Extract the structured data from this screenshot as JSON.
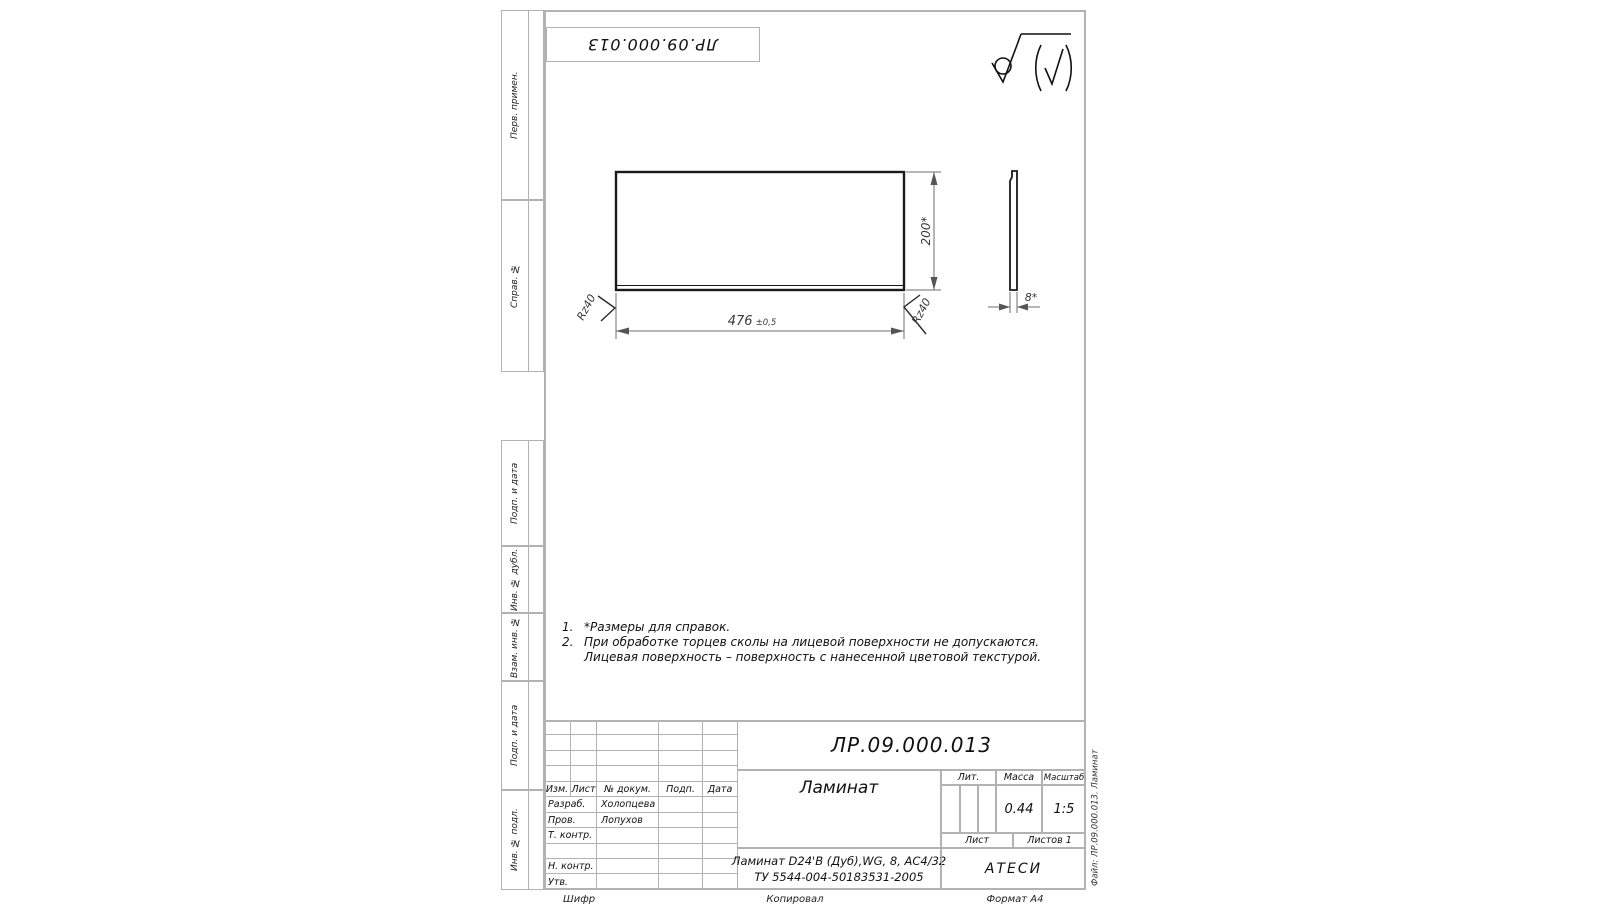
{
  "palette": {
    "frame_line": "#b2b2b2",
    "ink": "#1a1a1a"
  },
  "frame": {
    "stamp_designation": "ЛР.09.000.013",
    "file_note": "Файл: ЛР.09.000.013. Ламинат",
    "left_labels": [
      "Перв. примен.",
      "Справ. №",
      "Подп. и дата",
      "Инв. № дубл.",
      "Взам. инв. №",
      "Подп. и дата",
      "Инв. № подл."
    ],
    "footer": {
      "cipher": "Шифр",
      "copied": "Копировал",
      "format": "Формат А4"
    }
  },
  "drawing": {
    "dim_width_value": "476",
    "dim_width_tol": "±0,5",
    "dim_height": "200*",
    "dim_thickness": "8*",
    "roughness_left": "Rz40",
    "roughness_right": "Rz40"
  },
  "notes": {
    "items": [
      {
        "num": "1.",
        "line1": "*Размеры для справок.",
        "line2": ""
      },
      {
        "num": "2.",
        "line1": "При обработке торцев сколы на лицевой поверхности не допускаются.",
        "line2": "Лицевая поверхность – поверхность с нанесенной цветовой текстурой."
      }
    ]
  },
  "title_block": {
    "designation": "ЛР.09.000.013",
    "part_name": "Ламинат",
    "material_line1": "Ламинат D24'В (Дуб),WG, 8, АС4/32",
    "material_line2": "ТУ 5544-004-50183531-2005",
    "cols": {
      "izm": "Изм.",
      "list": "Лист",
      "doc": "№ докум.",
      "podp": "Подп.",
      "data": "Дата"
    },
    "roles": {
      "razrab_label": "Разраб.",
      "razrab_name": "Холопцева",
      "prov_label": "Пров.",
      "prov_name": "Лопухов",
      "tkontr_label": "Т. контр.",
      "nkontr_label": "Н. контр.",
      "utv_label": "Утв."
    },
    "lit_label": "Лит.",
    "mass_label": "Масса",
    "scale_label": "Масштаб",
    "mass_value": "0.44",
    "scale_value": "1:5",
    "sheet_label": "Лист",
    "sheets_label": "Листов 1",
    "company": "АТЕСИ"
  }
}
